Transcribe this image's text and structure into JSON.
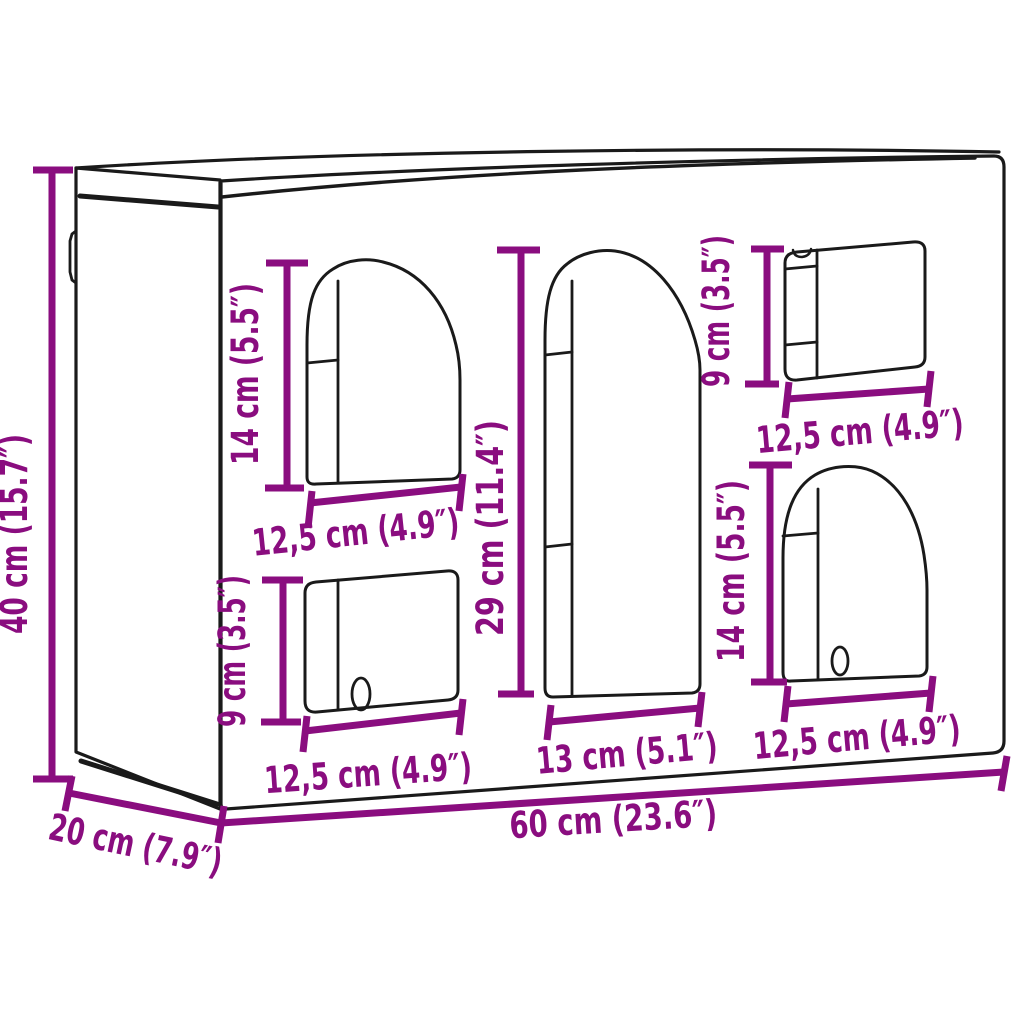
{
  "diagram": {
    "product": "wall-mounted cabinet with two arched doors, two rectangular doors and one tall central arched door",
    "view": "front perspective line drawing with dimension callouts",
    "accent_color": "#8A0D7F",
    "line_color": "#1a1a1a",
    "background_color": "#ffffff"
  },
  "dimensions": {
    "height": "40 cm (15.7″)",
    "depth": "20 cm (7.9″)",
    "width": "60 cm (23.6″)",
    "left_arch_height": "14 cm (5.5″)",
    "left_arch_width": "12,5 cm (4.9″)",
    "left_door_height": "9 cm (3.5″)",
    "left_door_width": "12,5 cm (4.9″)",
    "center_arch_height": "29 cm (11.4″)",
    "center_arch_width": "13 cm (5.1″)",
    "right_door_height": "9 cm (3.5″)",
    "right_door_width": "12,5 cm (4.9″)",
    "right_arch_height": "14 cm (5.5″)",
    "right_arch_width": "12,5 cm (4.9″)"
  }
}
